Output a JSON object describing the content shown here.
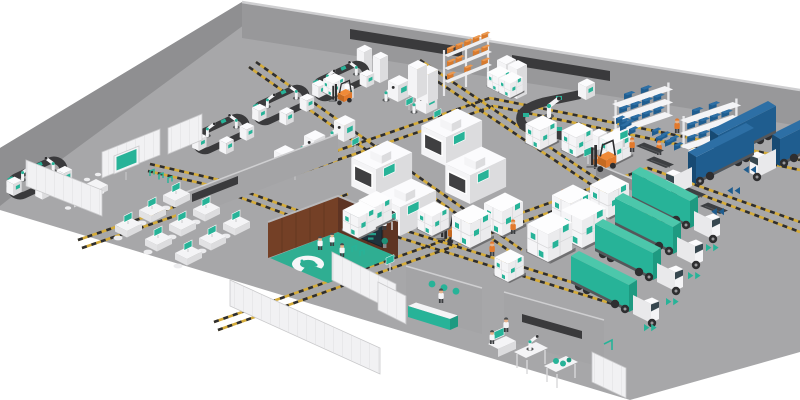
{
  "scene": {
    "description": "Isometric 3D illustration of a smart factory: robot assembly cells, CNC machines, AGV hazard lanes, warehouse racks, loading trucks, offices, control room and inspection lab",
    "background": "#ffffff"
  },
  "colors": {
    "bg": "#ffffff",
    "apron": "#a7a7a9",
    "wedge": "#8f8f91",
    "band": "#98989a",
    "bandtop": "#cfcfd1",
    "slot": "#3a3a3c",
    "graywall": "#a4a4a6",
    "panel": "#f1f1f3",
    "paneledge": "#c9c9cb",
    "hazy": "#d4ab3a",
    "dark": "#2e2e30",
    "belt": "#3a3a3c",
    "machine": "#f4f4f6",
    "mside": "#dcdcde",
    "mtop": "#fbfbfd",
    "opening": "#3f3f41",
    "teal": "#27b398",
    "teallight": "#4cc7ab",
    "tealdark": "#1e9a81",
    "tealfloor": "#2fae92",
    "wood": "#5e3423",
    "wood2": "#744026",
    "navy": "#20323c",
    "blue": "#1f5d8f",
    "bluelight": "#2d6fa5",
    "bluedark": "#174a73",
    "orange": "#e2792c",
    "orangelight": "#f08a38",
    "orangedark": "#c56a22",
    "boxorange": "#d97b2e",
    "boxorangetop": "#ec9a52",
    "white": "#f5f5f7",
    "skin": "#e8b48c",
    "glass": "#37474f",
    "metal": "#56585a",
    "gray3": "#e2e2e4"
  },
  "zones": [
    {
      "id": "assembly-cells",
      "label": "robot-assembly-loop-cells",
      "count": 4
    },
    {
      "id": "machining",
      "label": "cnc-machines",
      "count": 4
    },
    {
      "id": "storage-rack",
      "label": "pallet-rack-orange-boxes",
      "count": 1
    },
    {
      "id": "kitting",
      "label": "blue-bin-shelving",
      "count": 2
    },
    {
      "id": "inbound-dock",
      "label": "blue-trucks",
      "count": 3
    },
    {
      "id": "outbound-shipping",
      "label": "teal-trucks",
      "count": 4
    },
    {
      "id": "palletized-goods",
      "label": "white-teal-box-stacks",
      "count": 12
    },
    {
      "id": "office",
      "label": "open-office-desks",
      "count": 9
    },
    {
      "id": "control-room",
      "label": "wood-walled-control-room",
      "count": 1
    },
    {
      "id": "qa-lab",
      "label": "inspection-lab",
      "count": 1
    },
    {
      "id": "agv-network",
      "label": "hazard-striped-agv-lanes",
      "count": 7
    }
  ],
  "vehicles": {
    "teal_trucks": 4,
    "blue_trucks": 3,
    "forklifts": 3
  },
  "people": {
    "orange_workers": 6,
    "white_coat_staff": 7
  },
  "indicators": {
    "teal_floor_arrows": 4,
    "blue_floor_arrows": 3
  },
  "control_room_dashboard": {
    "has_bar_chart": true,
    "bar_count": 4,
    "screen_color": "#20323c",
    "accent_color": "#27b398"
  }
}
